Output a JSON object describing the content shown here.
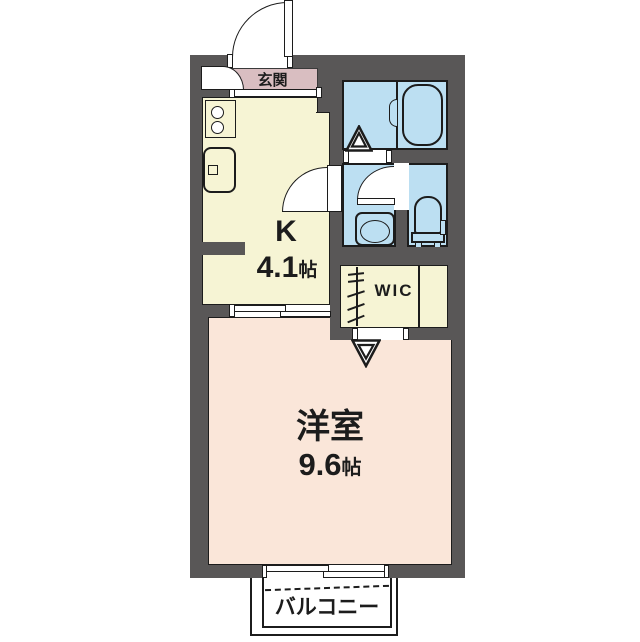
{
  "plan": {
    "type": "apartment-floor-plan",
    "rooms": {
      "entrance": {
        "label": "玄関"
      },
      "kitchen": {
        "label": "K",
        "size_value": "4.1",
        "size_unit": "帖"
      },
      "western_room": {
        "label": "洋室",
        "size_value": "9.6",
        "size_unit": "帖"
      },
      "wic": {
        "label": "WIC"
      },
      "balcony": {
        "label": "バルコニー"
      }
    },
    "colors": {
      "wall": "#595757",
      "kitchen_wic_fill": "#F6F4D4",
      "wet_area_fill": "#BCDFF2",
      "western_room_fill": "#FAE6D9",
      "entrance_fill": "#D9BEC1",
      "line": "#1c1c1c",
      "background": "#ffffff"
    },
    "icons": [
      "entrance-door-swing",
      "shoe-cabinet-door-swing",
      "entrance-step-marker",
      "stove-burners",
      "kitchen-sink",
      "bathtub",
      "bath-door-marker",
      "washbasin",
      "toilet",
      "toilet-door-swing",
      "kitchen-door-swing",
      "wic-folding-door",
      "wic-door-marker",
      "sliding-door",
      "sliding-window",
      "balcony-dashed-boundary"
    ]
  }
}
